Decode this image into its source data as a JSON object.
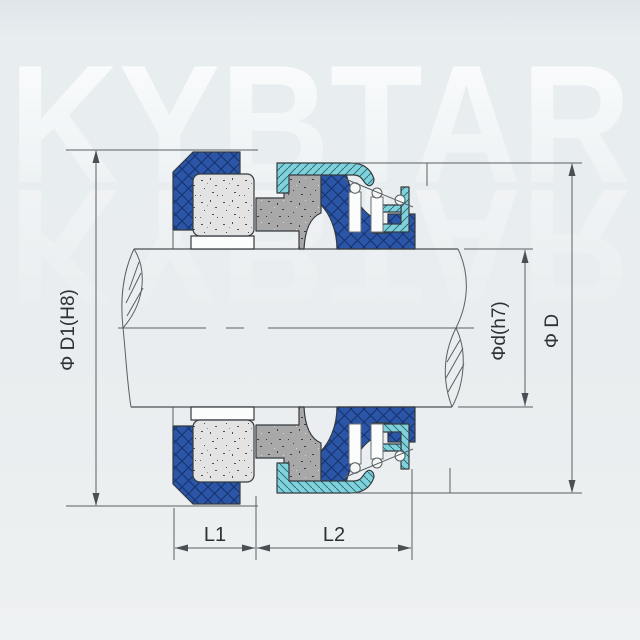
{
  "watermark": "KYBTAR",
  "dimensions": {
    "left_diameter": "Φ D1(H8)",
    "shaft_diameter": "Φd(h7)",
    "outer_diameter": "Φ D",
    "length_1": "L1",
    "length_2": "L2"
  },
  "colors": {
    "background_top": "#dfe6ea",
    "background_bottom": "#eef1f1",
    "watermark_white": "#ffffff",
    "elastomer_blue": "#2b56a7",
    "elastomer_hatch": "#16326e",
    "metal_cyan": "#7fd2db",
    "metal_cyan_hatch": "#2b626e",
    "ceramic_light_gray": "#e3e3e3",
    "carbon_gray": "#a8a8a8",
    "white_parts": "#fbfcfc",
    "drawing_line": "#343a3f",
    "dimension_line": "#5a5f63",
    "label_text": "#2c3136"
  }
}
